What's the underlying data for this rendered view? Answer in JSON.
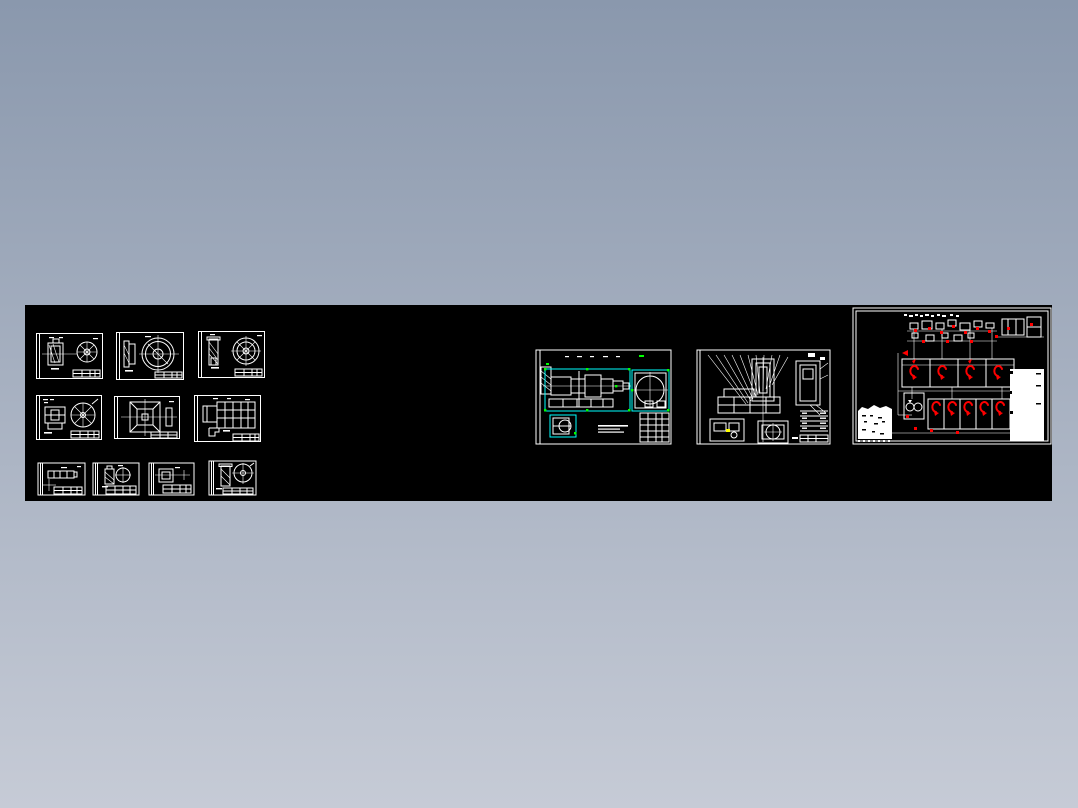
{
  "window": {
    "title": "cad-drawing-set-preview"
  },
  "background": {
    "gradient_top": "#8a98ad",
    "gradient_bottom": "#c6cbd6"
  },
  "canvas": {
    "background": "#000000"
  },
  "palette": {
    "line": "#ffffff",
    "selection_highlight": "#00ffff",
    "grip": "#00ff00",
    "markup_red": "#ff0000",
    "markup_yellow": "#ffff00"
  },
  "sheets": [
    {
      "id": "sheet-r1c1",
      "kind": "part-with-gear-wheel-view"
    },
    {
      "id": "sheet-r1c2",
      "kind": "section-with-ring-view"
    },
    {
      "id": "sheet-r1c3",
      "kind": "hatched-part-with-wheel-view"
    },
    {
      "id": "sheet-r2c1",
      "kind": "housing-with-spoked-gear-view"
    },
    {
      "id": "sheet-r2c2",
      "kind": "square-flange-view"
    },
    {
      "id": "sheet-r2c3",
      "kind": "fixture-assembly-grid-view"
    },
    {
      "id": "sheet-r3c1",
      "kind": "shaft-view"
    },
    {
      "id": "sheet-r3c2",
      "kind": "bushing-with-circle-view"
    },
    {
      "id": "sheet-r3c3",
      "kind": "plate-view"
    },
    {
      "id": "sheet-r3c4",
      "kind": "flange-with-circle-view"
    }
  ],
  "large_drawings": [
    {
      "id": "assembly-drawing",
      "state": "selected",
      "highlights": [
        "cyan-outline",
        "green-grips"
      ]
    },
    {
      "id": "fixture-callout-drawing",
      "state": "normal",
      "highlights": [
        "yellow-mark"
      ]
    },
    {
      "id": "hydraulic-schematic",
      "state": "red-markup",
      "highlights": [
        "red-valve-symbols"
      ]
    }
  ]
}
